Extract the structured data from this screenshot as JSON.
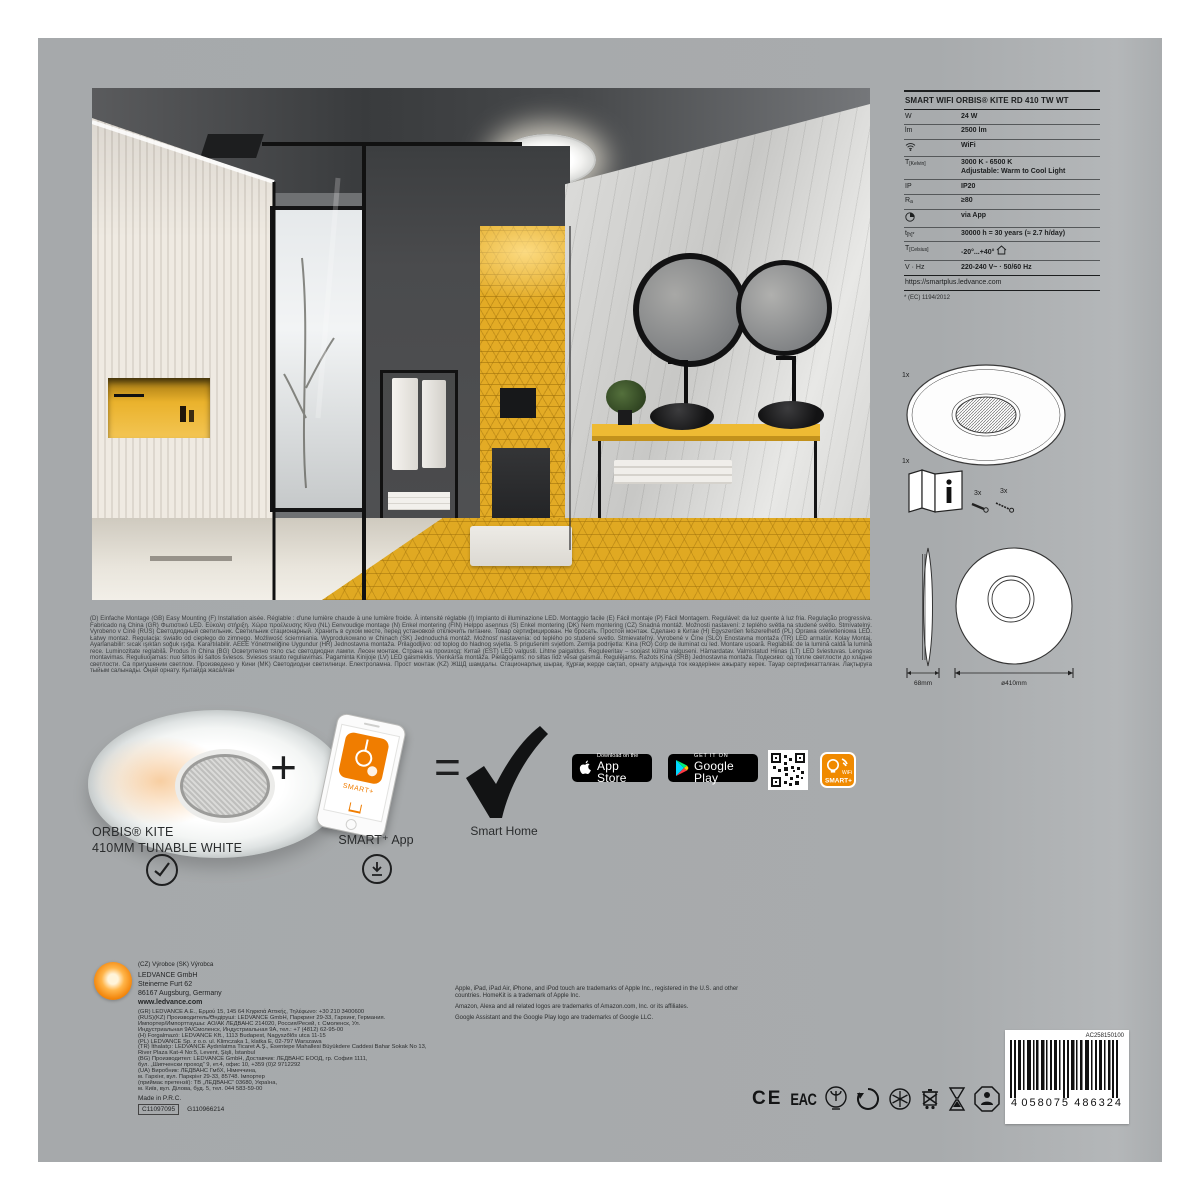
{
  "spec": {
    "title": "SMART WIFI ORBIS® KITE RD 410 TW WT",
    "rows": [
      {
        "key": "W",
        "sub": "",
        "value": "24 W"
      },
      {
        "key": "lm",
        "sub": "",
        "value": "2500 lm"
      },
      {
        "key": "",
        "sub": "",
        "value": "WiFi",
        "icon": "wifi-icon"
      },
      {
        "key": "T",
        "sub": "[Kelvin]",
        "value": "3000 K - 6500 K",
        "value2": "Adjustable: Warm to Cool Light"
      },
      {
        "key": "IP",
        "sub": "",
        "value": "IP20"
      },
      {
        "key": "R",
        "sub": "a",
        "value": "≥80"
      },
      {
        "key": "",
        "sub": "",
        "value": "via App",
        "icon": "dim-icon"
      },
      {
        "key": "t",
        "sub": "[h]*",
        "value": "30000 h = 30 years (≈ 2.7 h/day)"
      },
      {
        "key": "T",
        "sub": "[Celsius]",
        "value": "-20°...+40°",
        "icon2": "house-icon"
      },
      {
        "key": "V · Hz",
        "sub": "",
        "value": "220-240 V~ · 50/60 Hz"
      }
    ],
    "link": "https://smartplus.ledvance.com",
    "footnote": "* (EC) 1194/2012"
  },
  "contents": {
    "lamp_qty": "1x",
    "manual_qty": "1x",
    "screws_qty": "3x",
    "plugs_qty": "3x"
  },
  "dimensions": {
    "height": "68mm",
    "diameter": "ø410mm"
  },
  "multilang_text": "(D) Einfache Montage (GB) Easy Mounting (F) Installation aisée. Réglable : d'une lumière chaude à une lumière froide. À intensité réglable (I) Impianto di illuminazione LED. Montaggio facile (E) Fácil montaje (P) Fácil Montagem. Regulável: da luz quente à luz fria. Regulação progressiva. Fabricado na China (GR) Φωτιστικό LED. Εύκολη στήριξη. Χώρα προέλευσης Κίνα (NL) Eenvoudige montage (N) Enkel montering (FIN) Helppo asennus (S) Enkel montering (DK) Nem montering (CZ) Snadná montáž. Možnosti nastavení: z teplého světla na studené světlo. Stmívatelný. Vyrobeno v Číně (RUS) Светодиодный светильник. Светильник стационарный. Хранить в сухом месте, перед установкой отключить питание. Товар сертифицирован. Не бросать. Простой монтаж. Сделано в Китае (H) Egyszerűen felszerelhető (PL) Oprawa oświetleniowa LED. Łatwy montaż. Regulacja: światło od ciepłego do zimnego. Możliwość ściemniania. Wyprodukowano w Chinach (SK) Jednoduchá montáž. Možnosť nastavenia: od teplého po studené svetlo. Stmievateľný. Vyrobené v Číne (SLO) Enostavna montaža (TR) LED armatür. Kolay Montaj. Ayarlanabilir: sıcak ışıktan soğuk ışığa. Karartılabilir. AEEE Yönetmeliğine Uygundur (HR) Jednostavna montaža. Prilagodljivo: od toplog do hladnog svjetla. S prigušenim svjetlom. Zemlja podrijetla: Kina (RO) Corp de iluminat cu led. Montare ușoară. Reglabilă: de la lumină caldă la lumină rece. Luminozitate reglabilă. Produs în China (BG) Осветително тяло със светодиодни лампи. Лесен монтаж. Страна на произход: Китай (EST) LED valgusti. Lihtne paigaldus. Reguleeritav – soojast külma valguseni. Hämardatav. Valmistatud Hiinas (LT) LED šviestuvas. Lengvas montavimas. Reguliuojamas: nuo šiltos iki šaltos šviesos. Šviesos srauto reguliavimas. Pagaminta Kinijoje (LV) LED gaismeklis. Vienkārša montāža. Pielāgojams: no siltas līdz vēsai gaismai. Regulējams. Ražots Ķīnā (SRB) Jednostavna montaža. Подесиво: од топле светлости до хладне светлости. Са пригушеним светлом. Произведено у Кини (MK) Светодиодни светилници. Електроламна. Прост монтаж (KZ) ЖШД шамдалы. Стационарлық шырақ. Құрғақ жерде сақтап, орнату алдында ток көздерінен ажырату керек. Тауар сертификатталған. Лақтыруға тыйым салынады. Оңай орнату. Қытайда жасалған",
  "product_row": {
    "name_line1": "ORBIS® KITE",
    "name_line2": "410MM TUNABLE WHITE",
    "plus": "+",
    "equals": "=",
    "app_label": "SMART⁺ App",
    "phone_screen_text": "SMART+",
    "smart_home": "Smart Home"
  },
  "badges": {
    "app_store_line1": "Download on the",
    "app_store_line2": "App Store",
    "google_play_line1": "GET IT ON",
    "google_play_line2": "Google Play",
    "smart_line1": "WiFi",
    "smart_line2": "SMART+"
  },
  "manufacturer": {
    "origin_line": "(CZ) Výrobce (SK) Výrobca",
    "name": "LEDVANCE GmbH",
    "street": "Steinerne Furt 62",
    "city": "86167 Augsburg, Germany",
    "web": "www.ledvance.com",
    "small_lines": [
      "(GR) LEDVANCE A.E., Ερμού 15, 145 64 Κηφισιά Αττικής, Τηλέφωνο: +30 210 3400600",
      "(RUS)(KZ) Производитель/Өндіруші: LEDVANCE GmbH, Паркринг 29-33, Гархинг, Германия.",
      "Импортер/Импорттаушы: АО/АК ЛЕДВАНС 214020, Россия/Ресей, г. Смоленск, Ул.",
      "Индустриальная 9А/Смоленск, Индустриальная 9А, тел.: +7 (4812) 62-95-00",
      "(H) Forgalmazó: LEDVANCE Kft., 1113 Budapest, Nagyszőlős utca 11-15",
      "(PL) LEDVANCE Sp. z o.o. ul. Klimczaka 1, klatka E, 02-797 Warszawa",
      "(TR) İthalatçı: LEDVANCE Aydınlatma Ticaret A.Ş., Esentepe Mahallesi Büyükdere Caddesi Bahar Sokak No 13,",
      "River Plaza Kat-4 No:5, Levent, Şişli, İstanbul",
      "(BG) Производител: LEDVANCE GmbH, Доставчик: ЛЕДВАНС ЕООД, гр. София 1111,",
      "бул. „Шипченски проход“ 9, ет.4, офис 10, +359 (0)2 9712292",
      "(UA) Виробник: ЛЕДВАНС ГмбХ, Німеччина,",
      "м. Гархінг, вул. Паркрінг 29-33, 85748. Імпортер",
      "(приймає претензії): ТВ „ЛЕДВАНС“ 03680, Україна,",
      "м. Київ, вул. Ділова, буд. 5, тел. 044 583-59-00"
    ],
    "made_in": "Made in P.R.C.",
    "code_boxed": "C11097095",
    "code_plain": "G110966214"
  },
  "legal": {
    "lines": [
      "Apple, iPad, iPad Air, iPhone, and iPod touch are trademarks of Apple Inc., registered in the U.S. and other countries. HomeKit is a trademark of Apple Inc.",
      "Amazon, Alexa and all related logos are trademarks of Amazon.com, Inc. or its affiliates.",
      "Google Assistant and the Google Play logo are trademarks of Google LLC."
    ]
  },
  "certifications": {
    "ce": "CE",
    "eac": "EAC",
    "rohs": "RoHS"
  },
  "barcode": {
    "top_code": "AC258150100",
    "digit_lead": "4",
    "digits_left": "058075",
    "digits_right": "486324"
  },
  "colors": {
    "package_gray": "#a8abad",
    "accent_orange": "#f07d00",
    "tile_yellow": "#e3ab25",
    "badge_black": "#000000"
  }
}
